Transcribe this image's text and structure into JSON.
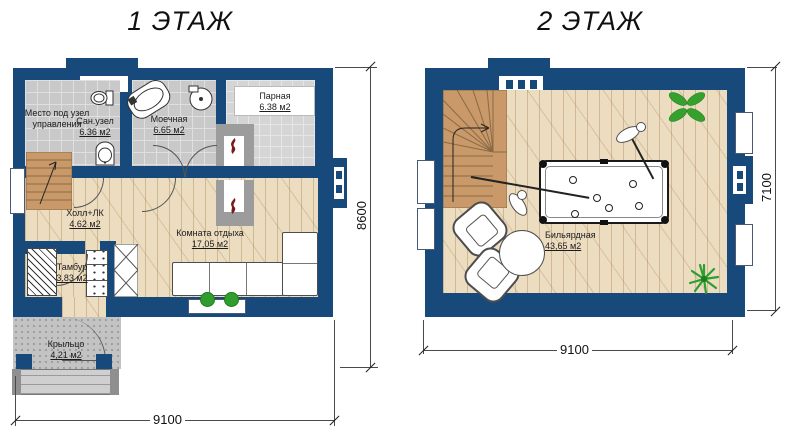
{
  "titles": {
    "floor1": "1 ЭТАЖ",
    "floor2": "2 ЭТАЖ"
  },
  "floor1": {
    "rooms": {
      "control": {
        "name": "Место под узел управления"
      },
      "sanuzel": {
        "name": "Сан.узел",
        "area": "6.36 м2"
      },
      "moechnaya": {
        "name": "Моечная",
        "area": "6.65 м2"
      },
      "parnaya": {
        "name": "Парная",
        "area": "6.38 м2"
      },
      "hall": {
        "name": "Холл+ЛК",
        "area": "4.62 м2"
      },
      "rest": {
        "name": "Комната отдыха",
        "area": "17,05 м2"
      },
      "tambur": {
        "name": "Тамбур",
        "area": "3,83 м2"
      },
      "porch": {
        "name": "Крыльцо",
        "area": "4,21 м2"
      }
    },
    "dimensions": {
      "width_mm": "9100",
      "height_mm": "8600"
    }
  },
  "floor2": {
    "rooms": {
      "billiard": {
        "name": "Бильярдная",
        "area": "43,65 м2"
      }
    },
    "dimensions": {
      "width_mm": "9100",
      "height_mm": "7100"
    }
  },
  "colors": {
    "wall": "#17497B",
    "wood_floor": "#ECDDC1",
    "tile_floor": "#C9C9C9",
    "stair_wood": "#C9996A",
    "porch_concrete": "#C3C3C3",
    "plant_green": "#36A02E",
    "flame_red": "#7A1B1B"
  }
}
